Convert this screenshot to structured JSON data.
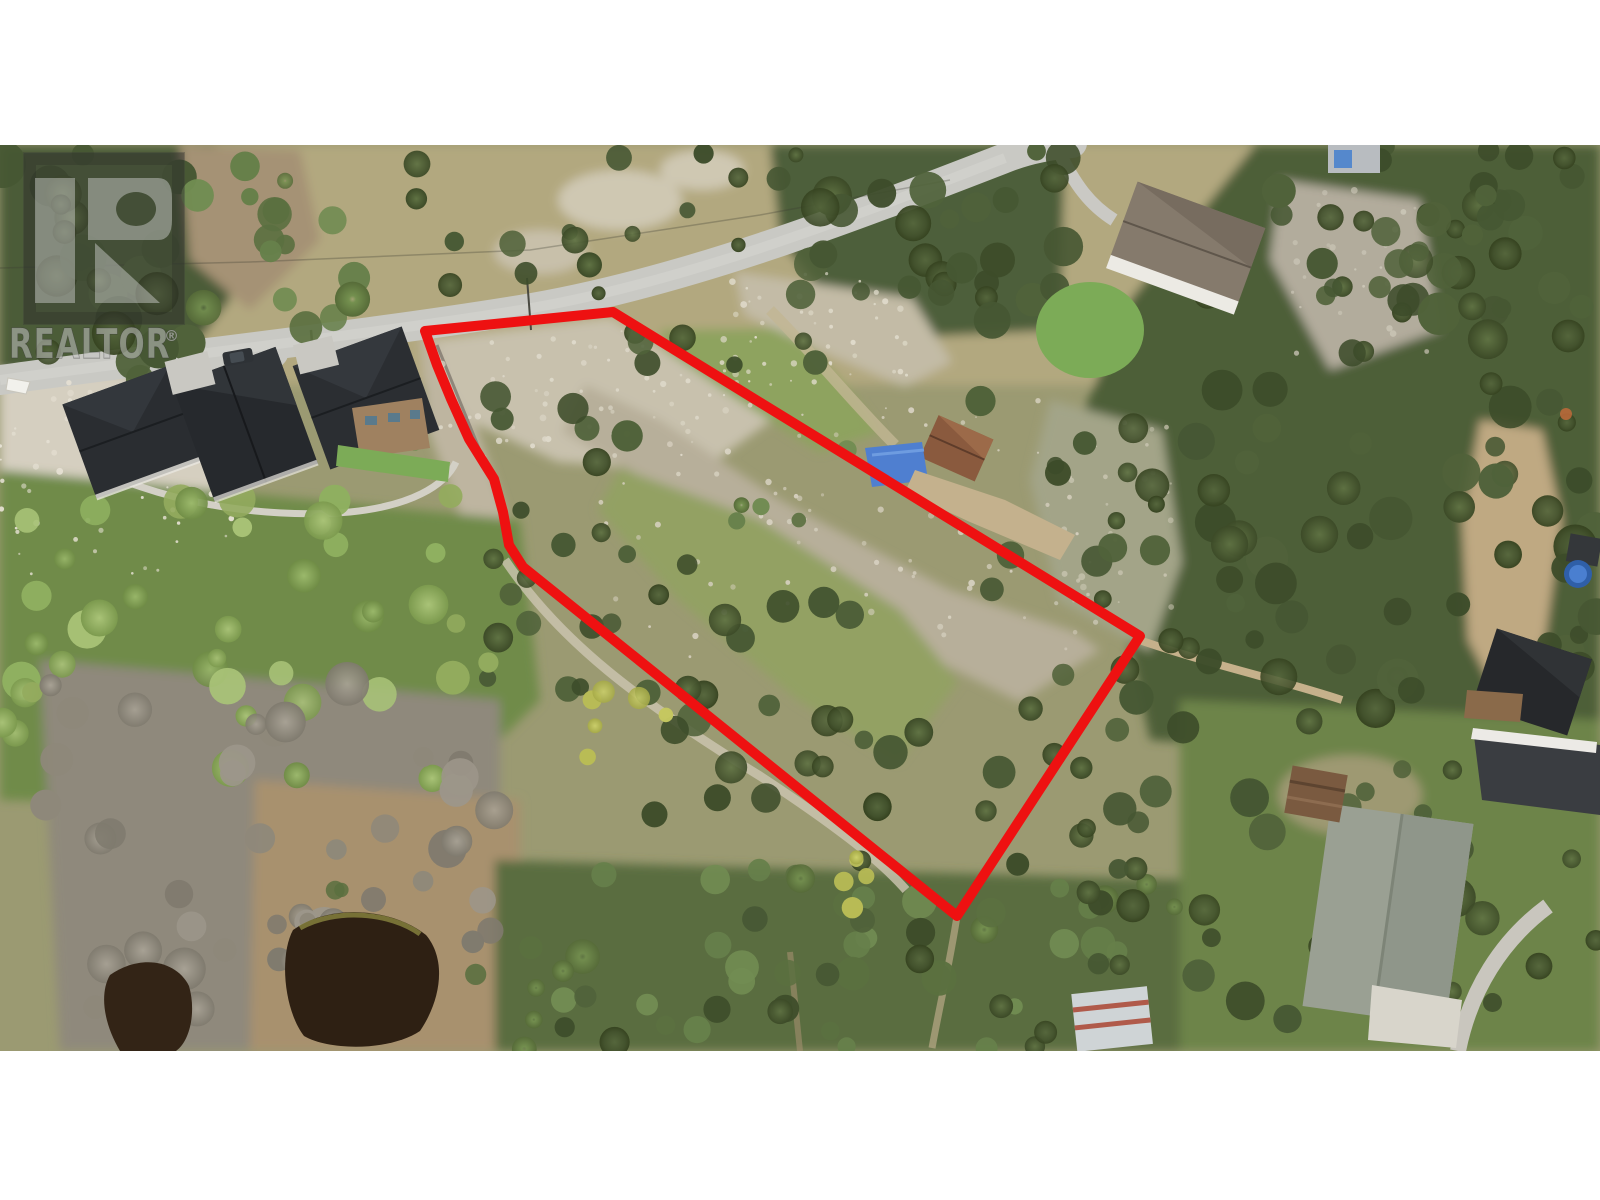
{
  "page": {
    "width": 1600,
    "height": 1200,
    "letterbox_color": "#ffffff"
  },
  "photo": {
    "kind": "aerial-drone-photo",
    "top": 145,
    "height": 906,
    "subject": "treed-vacant-lot-with-outlined-property-boundary"
  },
  "watermark": {
    "text": "REALTOR",
    "registered": "®",
    "logo": "realtor-block-r-logo",
    "tint": "rgba(55,55,55,0.34)",
    "glyph_tint": "rgba(225,225,225,0.42)"
  },
  "boundary": {
    "label": "property-boundary-outline",
    "color": "#ee1111",
    "stroke_width": 10,
    "points": "425,331 613,312 1140,636 957,916 523,567 509,545 503,512 494,479 469,439 451,399 437,365"
  },
  "road": {
    "label": "residential-street",
    "path": "M0,380 C180,355 360,336 520,310 C680,284 850,218 1005,158 C1030,148 1052,145 1072,143",
    "color": "#c9c9c4",
    "width": 30
  },
  "colors": {
    "boundary_red": "#ee1111",
    "road_gray": "#c9c9c4",
    "gravel_light": "#d6d0c2",
    "rock_band": "#b7af9a",
    "meadow_green": "#95a365",
    "dry_grass": "#b2a87f",
    "conifer_dark": "#46552f",
    "deciduous_green": "#86a558",
    "dead_brush_gray": "#8f897b",
    "marsh_tan": "#a8916e",
    "pond_dark": "#2e2013",
    "house_roof_dark": "#2a2d31",
    "shingle_roof_gray": "#9aa093",
    "neighbor_roof_brown": "#857a6c",
    "cabin_brown": "#8a5a3e",
    "tarp_blue": "#4f7fd0",
    "lawn_green": "#7cab57",
    "pool_blue": "#2f5fa8"
  }
}
